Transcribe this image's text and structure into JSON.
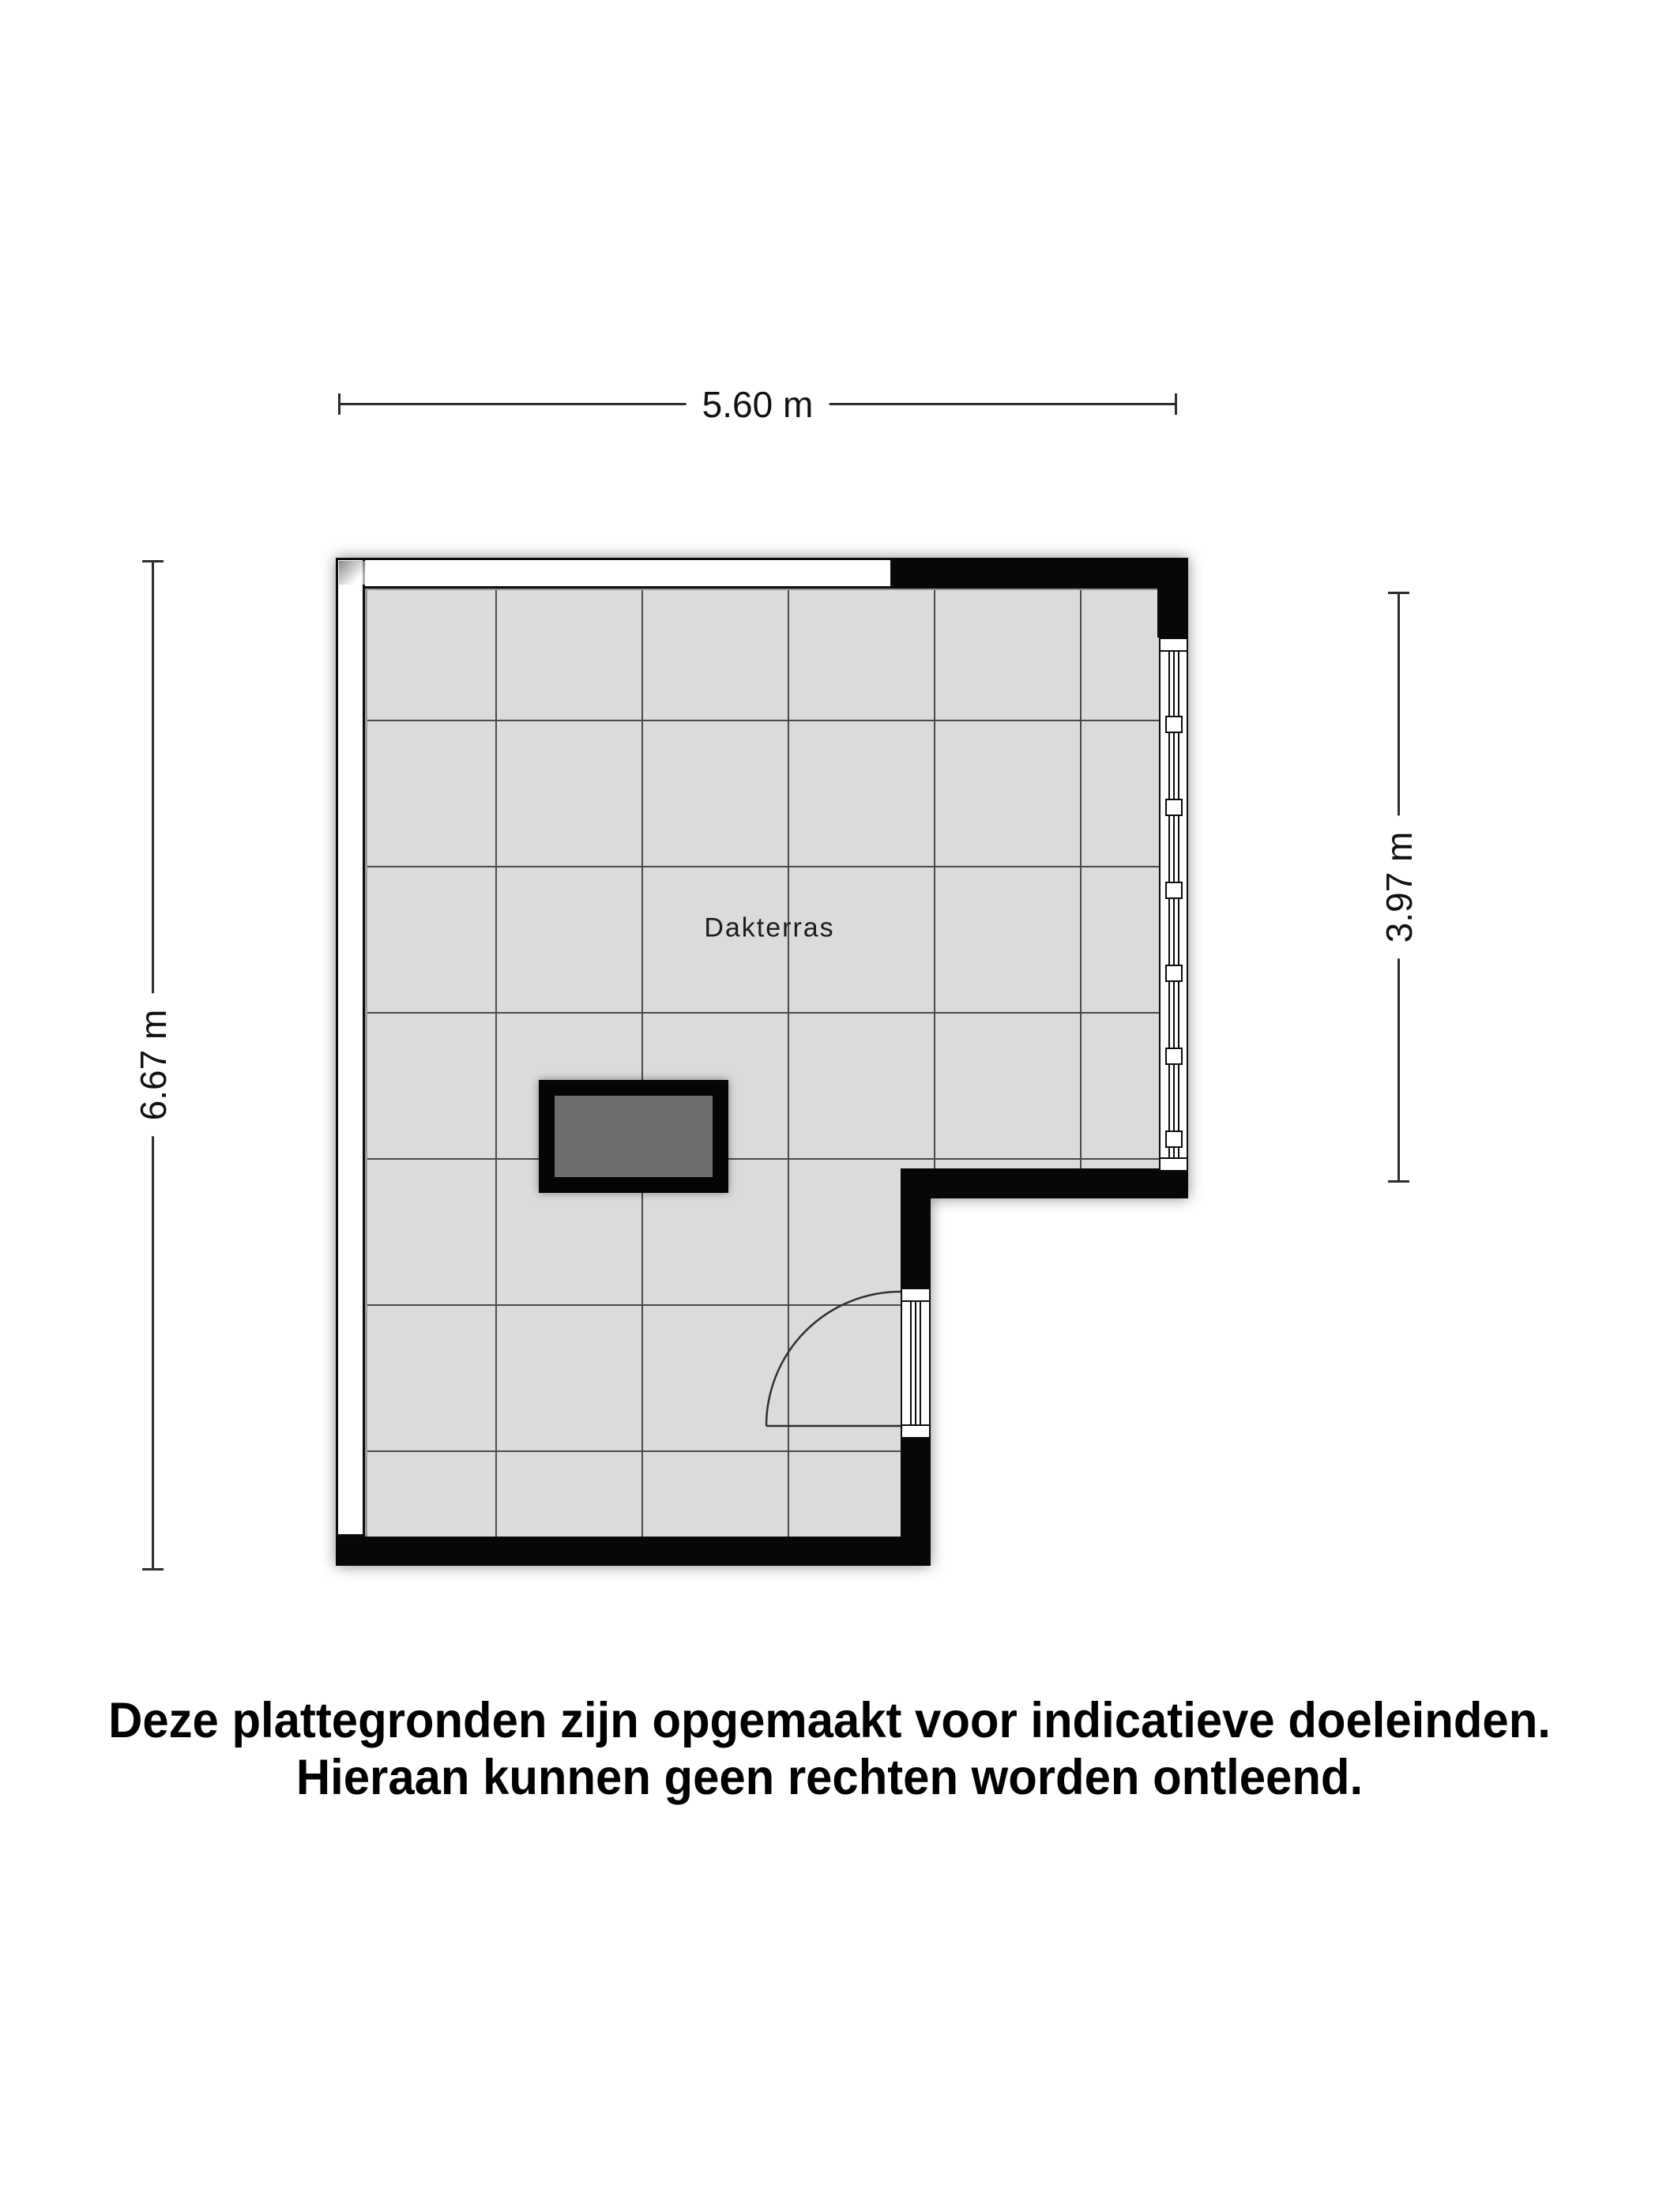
{
  "plan": {
    "room": {
      "label": "Dakterras"
    },
    "dimensions": {
      "width_top": "5.60 m",
      "height_left": "6.67 m",
      "height_right": "3.97 m"
    },
    "disclaimer": {
      "line1": "Deze plattegronden zijn opgemaakt voor indicatieve doeleinden.",
      "line2": "Hieraan kunnen geen rechten worden ontleend."
    },
    "colors": {
      "floor": "#dbdbdb",
      "grid_line": "#4a4a4a",
      "wall": "#070707",
      "window_band": "#ffffff",
      "skylight_fill": "#6f6f6f",
      "background": "#ffffff"
    }
  }
}
